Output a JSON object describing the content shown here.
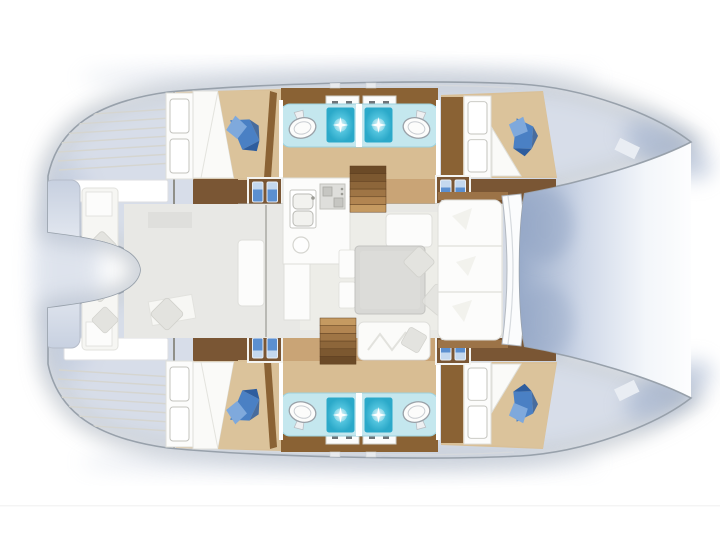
{
  "meta": {
    "title": "Catamaran yacht interior layout — top-down floor plan (4 cabins, 4 heads)",
    "domain": "diagram",
    "visible_text": "none"
  },
  "canvas": {
    "width": 720,
    "height": 540,
    "background": "#ffffff"
  },
  "palette": {
    "bg": "#ffffff",
    "hullwhite": "#ffffff",
    "white": "#fcfcfb",
    "outline": "#98a1ab",
    "deckline": "#d6d9dd",
    "seam": "#dededa",
    "wall": "#a9a9a3",
    "glow": "#b7c3d8",
    "glow2": "#8fa2c2",
    "floor": "#e8e8e5",
    "floor2": "#dfdfdc",
    "salonfloor": "#edede9",
    "tan": "#d9c098",
    "tanmid": "#d8bd93",
    "bed": "#dbc39b",
    "sheet": "#fafaf8",
    "brown": "#8a6234",
    "darkbrown": "#6b4a27",
    "corridordark": "#7a5634",
    "corridortan": "#c9a476",
    "trim": "#9c7347",
    "cyanband": "#c4e7ee",
    "cyanedge": "#9cd1dd",
    "showerlight": "#d8f4f9",
    "shower": "#52c4de",
    "showerdeep": "#2ba9c9",
    "blanket": "#4a80c4",
    "blanketlight": "#7fa9dc",
    "blanketdark": "#2e5d9e",
    "unitblue": "#5b8fd0",
    "unitcap": "#cfe0f2",
    "graymed": "#d8d8d5",
    "graypillow": "#e3e3df",
    "toiletline": "#9aa1a8",
    "tramp1": "#9aacca",
    "tramp2": "#cfd8e8",
    "tramp3": "#f3f6fa",
    "plat1": "#c7d0e0",
    "plat2": "#eef1f6",
    "s1": "#6b4a27",
    "s2": "#7c5830",
    "s3": "#8d663a",
    "s4": "#9f7545",
    "s5": "#b28551",
    "s6": "#c59a61"
  },
  "vessel": {
    "type": "sailing catamaran, twin-hull floor plan seen from above",
    "orientation": {
      "bows": "right (pointed)",
      "sterns": "left (transom steps)"
    },
    "hulls": [
      {
        "position": "top",
        "aft_cabin": {
          "double_bed": true,
          "blue_blanket": true,
          "wardrobe_doors": 2
        },
        "bathroom_suite": {
          "toilets": 2,
          "showers": 2,
          "sink_counters": 2,
          "divider_wall": true
        },
        "fwd_cabin": {
          "double_bed": true,
          "blue_blanket": true,
          "wardrobe_doors": 2
        },
        "storage_units_blue": 2,
        "transom_steps": true
      },
      {
        "position": "bottom",
        "aft_cabin": {
          "double_bed": true,
          "blue_blanket": true,
          "wardrobe_doors": 2
        },
        "bathroom_suite": {
          "toilets": 2,
          "showers": 2,
          "sink_counters": 2,
          "divider_wall": true
        },
        "fwd_cabin": {
          "double_bed": true,
          "blue_blanket": true,
          "wardrobe_doors": 2
        },
        "storage_units_blue": 2,
        "transom_steps": true
      }
    ],
    "saloon": {
      "galley": {
        "double_sink": true,
        "stove_burners": 2,
        "round_fixture": 1
      },
      "companionway_stairs": 2,
      "dinette": {
        "table": true,
        "seat_cushions": 4,
        "throw_pillows": 4
      },
      "forward_settee": {
        "sections": 3
      },
      "windshield": true
    },
    "cockpit": {
      "aft_bench": true,
      "bench_cushions": 2,
      "throw_pillows": 3,
      "stern_platform": true,
      "cockpit_table": true
    },
    "foredeck": {
      "area_between_bows": "shaded blue (trampoline)",
      "bow_deck_fittings": 2
    }
  },
  "symbols": [
    "blue-blanket-icon",
    "toilet-icon",
    "shower-sparkle-icon",
    "twin-storage-icon",
    "stairs-icon",
    "pillow-icon",
    "double-sink-icon",
    "stove-icon",
    "wardrobe-icon"
  ]
}
